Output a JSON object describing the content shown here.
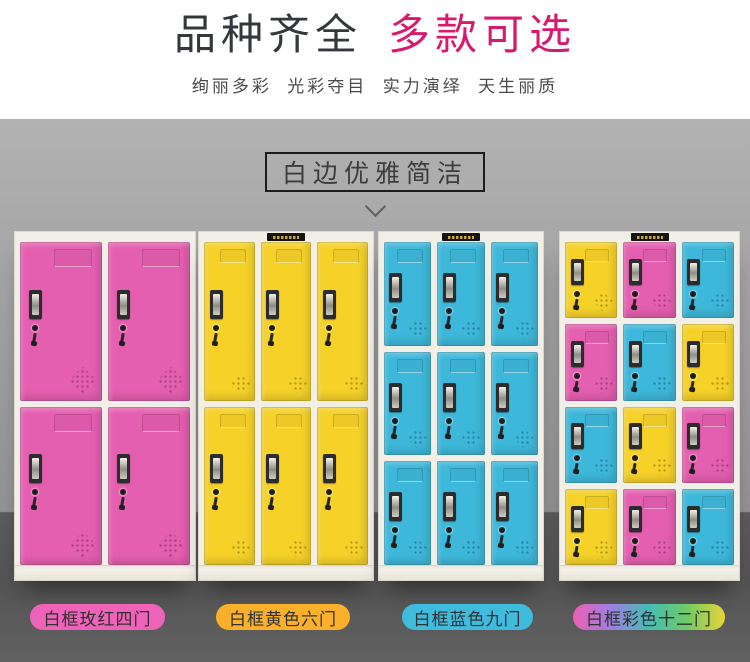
{
  "hero": {
    "title_dark": "品种齐全",
    "title_accent": "多款可选",
    "accent_color": "#d8196e",
    "title_color": "#34383d",
    "tagline": "绚丽多彩  光彩夺目  实力演绎  天生丽质"
  },
  "banner": {
    "label": "白边优雅简洁",
    "chevron_icon": "chevron-down"
  },
  "colors": {
    "door_pink": "#e55fb0",
    "door_yellow": "#f6d229",
    "door_blue": "#3eb8da",
    "frame_white": "#f2efe7",
    "wall_gray": "#9b9b9b",
    "floor_gray": "#5a5a5a"
  },
  "lockers": [
    {
      "label": "白框玫红四门",
      "label_bg": "#ee63b8",
      "rows": 2,
      "cols": 2,
      "brand_plate": false,
      "doors": [
        "pink",
        "pink",
        "pink",
        "pink"
      ]
    },
    {
      "label": "白框黄色六门",
      "label_bg": "#fbb02c",
      "rows": 2,
      "cols": 3,
      "brand_plate": true,
      "doors": [
        "yellow",
        "yellow",
        "yellow",
        "yellow",
        "yellow",
        "yellow"
      ]
    },
    {
      "label": "白框蓝色九门",
      "label_bg": "#3fbcdd",
      "rows": 3,
      "cols": 3,
      "brand_plate": true,
      "doors": [
        "blue",
        "blue",
        "blue",
        "blue",
        "blue",
        "blue",
        "blue",
        "blue",
        "blue"
      ]
    },
    {
      "label": "白框彩色十二门",
      "label_bg_gradient": [
        "#ee5fb4",
        "#9d7fe0",
        "#45bdb4",
        "#6ecb67",
        "#e8d435"
      ],
      "rows": 4,
      "cols": 3,
      "brand_plate": true,
      "doors": [
        "yellow",
        "pink",
        "blue",
        "pink",
        "blue",
        "yellow",
        "blue",
        "yellow",
        "pink",
        "yellow",
        "pink",
        "blue"
      ]
    }
  ]
}
